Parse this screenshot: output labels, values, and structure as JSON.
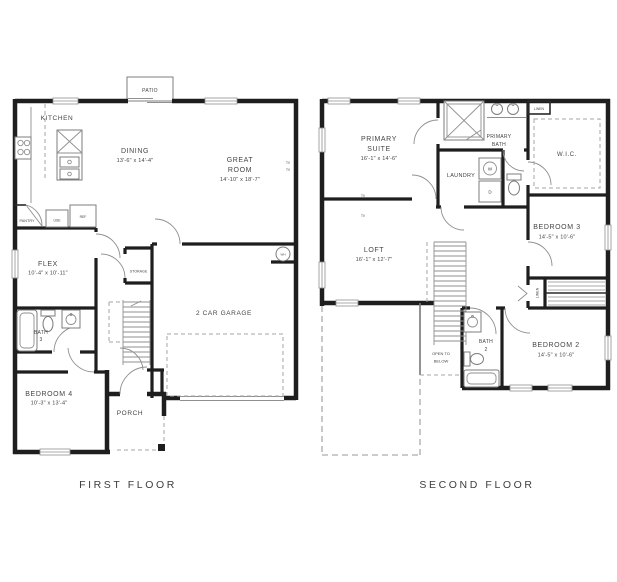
{
  "colors": {
    "wall": "#1e1e1e",
    "thin_line": "#8f8f8f",
    "text": "#454545",
    "background": "#ffffff"
  },
  "ff": {
    "title": "FIRST FLOOR",
    "patio": "PATIO",
    "kitchen": "KITCHEN",
    "pantry": "PANTRY",
    "cabinet": "USE",
    "ref": "REF",
    "dining": {
      "name": "DINING",
      "dims": "13'-6\" x 14'-4\""
    },
    "great": {
      "l1": "GREAT",
      "l2": "ROOM",
      "dims": "14'-10\" x 18'-7\""
    },
    "tv": "TV",
    "flex": {
      "name": "FLEX",
      "dims": "10'-4\" x 10'-11\""
    },
    "storage": "STORAGE",
    "bath3": {
      "l1": "BATH",
      "l2": "3"
    },
    "bed4": {
      "name": "BEDROOM 4",
      "dims": "10'-3\" x 13'-4\""
    },
    "garage": "2 CAR GARAGE",
    "wh": "WH",
    "porch": "PORCH"
  },
  "sf": {
    "title": "SECOND FLOOR",
    "suite": {
      "l1": "PRIMARY",
      "l2": "SUITE",
      "dims": "16'-1\" x 14'-6\""
    },
    "pbath": {
      "l1": "PRIMARY",
      "l2": "BATH"
    },
    "linen_top": "LINEN",
    "wic": "W.I.C.",
    "laundry": "LAUNDRY",
    "washer": "W",
    "dryer": "D",
    "tv": "TV",
    "loft": {
      "name": "LOFT",
      "dims": "16'-1\" x 12'-7\""
    },
    "bed3": {
      "name": "BEDROOM 3",
      "dims": "14'-5\" x 10'-6\""
    },
    "linen_side": "LINEN",
    "bath2": {
      "l1": "BATH",
      "l2": "2"
    },
    "open": {
      "l1": "OPEN TO",
      "l2": "BELOW"
    },
    "bed2": {
      "name": "BEDROOM 2",
      "dims": "14'-5\" x 10'-6\""
    }
  }
}
